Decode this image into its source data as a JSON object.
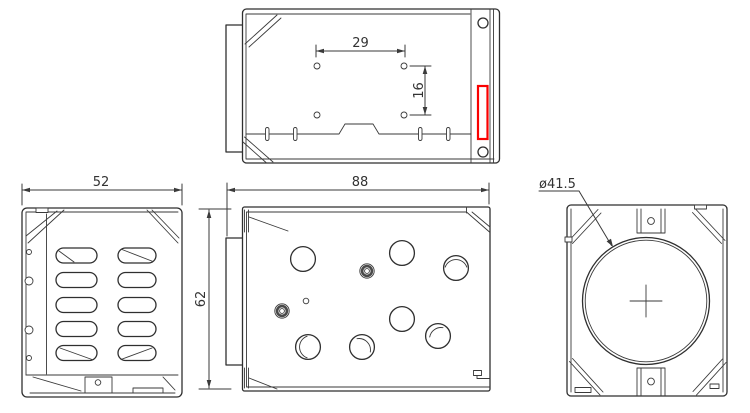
{
  "colors": {
    "line": "#2f2f2f",
    "dimension_text": "#333333",
    "highlight_red": "#fa0000",
    "background": "#ffffff"
  },
  "views": {
    "top": {
      "dim_hole_spacing_horizontal": "29",
      "dim_hole_spacing_vertical": "16"
    },
    "side": {
      "dim_depth": "52"
    },
    "front": {
      "dim_width": "88",
      "dim_height": "62"
    },
    "rear": {
      "dim_opening_diameter": "ø41.5"
    }
  }
}
